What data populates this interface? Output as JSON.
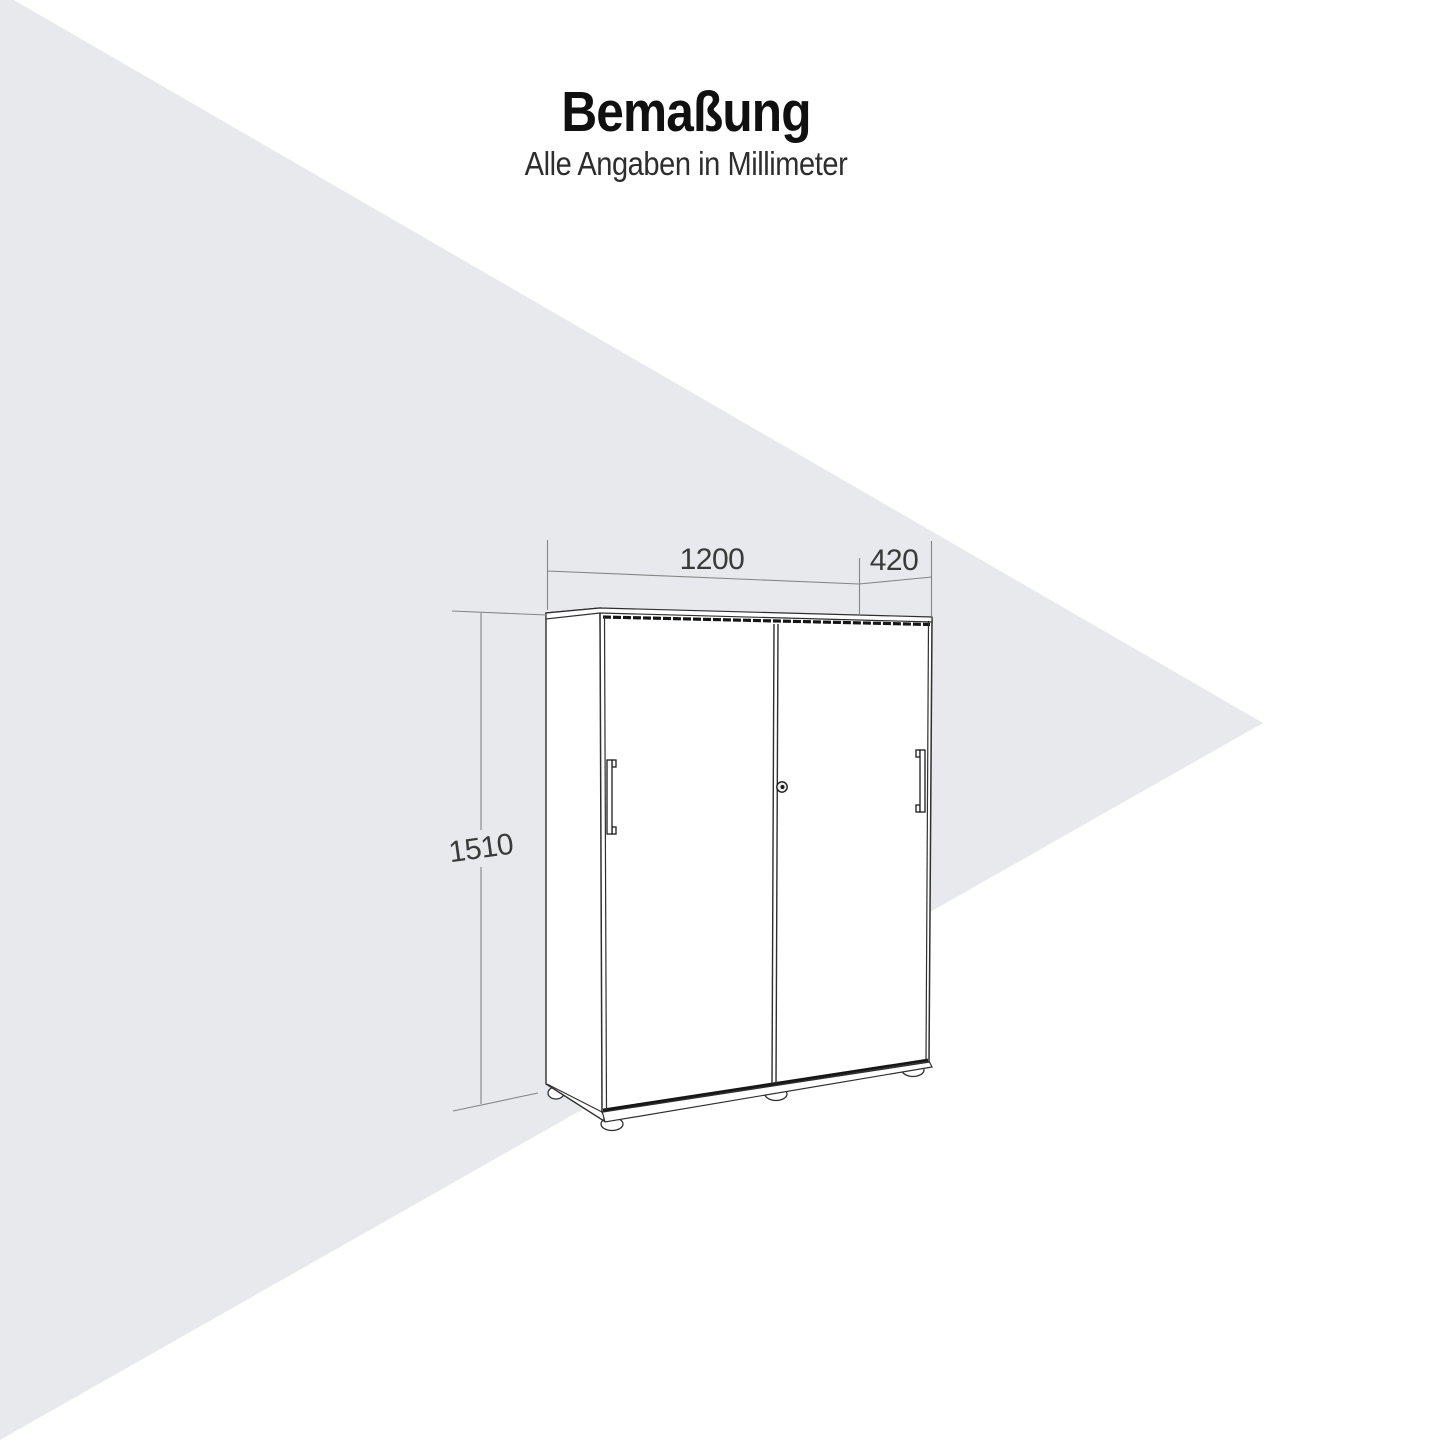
{
  "header": {
    "title": "Bemaßung",
    "subtitle": "Alle Angaben in Millimeter"
  },
  "drawing": {
    "unit": "Millimeter",
    "dimensions": {
      "width": "1200",
      "depth": "420",
      "height": "1510"
    }
  },
  "colors": {
    "background": "#ffffff",
    "shadow_wedge": "#e7e9ed",
    "cabinet_outline": "#2f2f2f",
    "heavy_rail": "#161616",
    "dimension_line": "#858585",
    "label_text": "#3a3a3a",
    "title_text": "#101010"
  }
}
